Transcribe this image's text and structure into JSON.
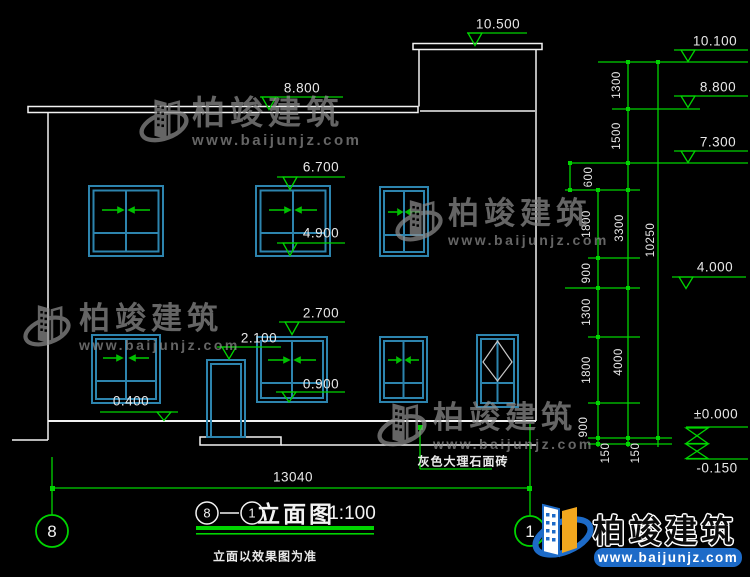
{
  "drawing": {
    "building_marks": [
      {
        "label": "10.500"
      },
      {
        "label": "8.800"
      },
      {
        "label": "6.700"
      },
      {
        "label": "4.900"
      },
      {
        "label": "2.700"
      },
      {
        "label": "2.100"
      },
      {
        "label": "0.900"
      },
      {
        "label": "0.400"
      }
    ],
    "level_marks": [
      {
        "label": "10.100"
      },
      {
        "label": "8.800"
      },
      {
        "label": "7.300"
      },
      {
        "label": "4.000"
      },
      {
        "label": "±0.000"
      },
      {
        "label": "-0.150"
      }
    ],
    "dims_vertical": [
      "1300",
      "1500",
      "600",
      "1800",
      "900",
      "1300",
      "1800",
      "900",
      "150",
      "150",
      "3300",
      "4000",
      "10250"
    ],
    "dim_width": "13040",
    "axis_bubbles": {
      "left": "8",
      "right": "1"
    },
    "titleblock": {
      "axis_a": "8",
      "sep": "—",
      "axis_b": "1",
      "name": "立面图",
      "scale": "1:100",
      "subtitle": "立面以效果图为准"
    },
    "note_material": "灰色大理石面砖"
  },
  "brand": {
    "name": "柏竣建筑",
    "site": "www.baijunjz.com"
  },
  "colors": {
    "line": "#f2f2f2",
    "dimension": "#00d400",
    "window_frame": "#2d84ae",
    "arrow": "#00c000",
    "watermark": "#8d8d8d",
    "logo_blue": "#1d6bc8",
    "logo_yellow": "#f2a71e",
    "background": "#000000"
  }
}
